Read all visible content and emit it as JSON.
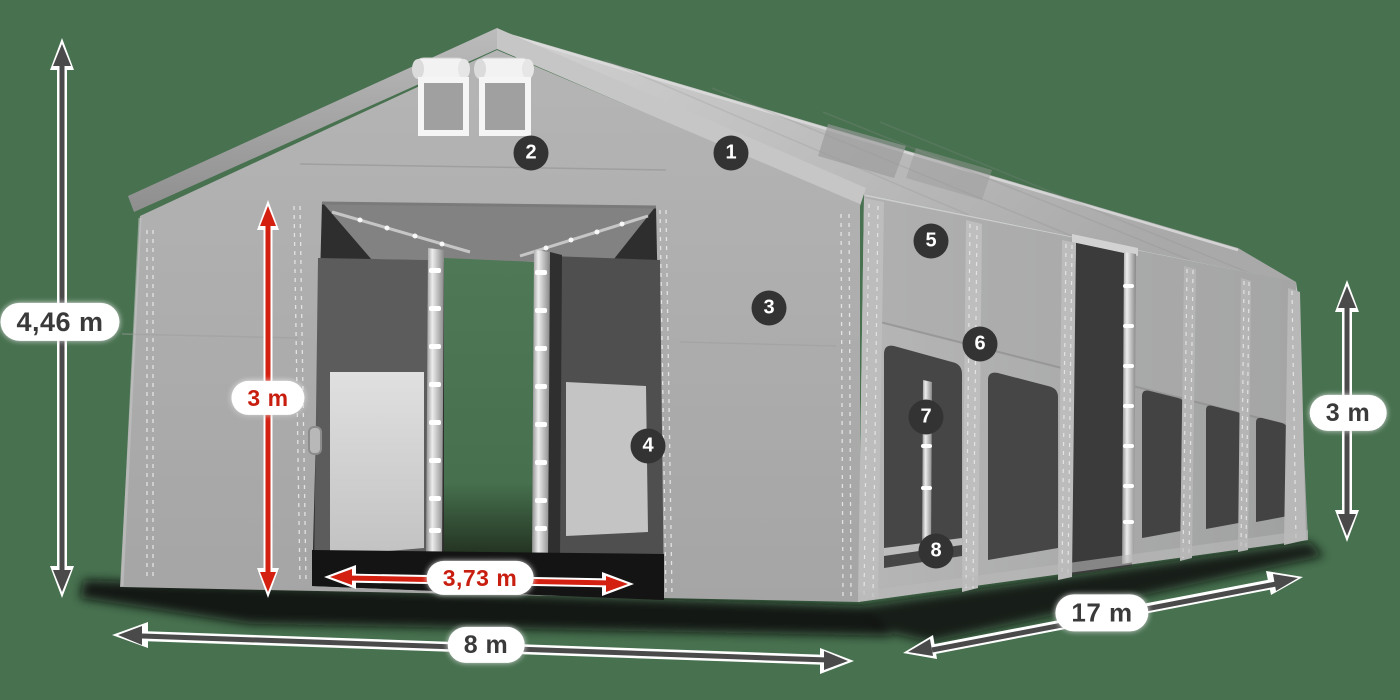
{
  "scene": {
    "description": "3D product diagram of a gray PVC storage tent hall, front-left view with open entrance doors and side wall windows",
    "background_color": "#47714F"
  },
  "dimensions": {
    "ridge_height": "4,46 m",
    "door_height": "3 m",
    "door_width": "3,73 m",
    "front_width": "8 m",
    "side_length": "17 m",
    "side_height": "3 m"
  },
  "markers": [
    "1",
    "2",
    "3",
    "4",
    "5",
    "6",
    "7",
    "8"
  ],
  "colors": {
    "dimension_red": "#D32011",
    "dimension_dark": "#4A4A4A",
    "label_text_dark": "#3A3A3A",
    "label_text_red": "#C81E10",
    "badge_background": "#333333",
    "tent_gray": "#ACACAC",
    "roof_light_gray": "#C9C9C9",
    "window_dark": "#464646",
    "interior_window_light": "#D6D6D6"
  }
}
